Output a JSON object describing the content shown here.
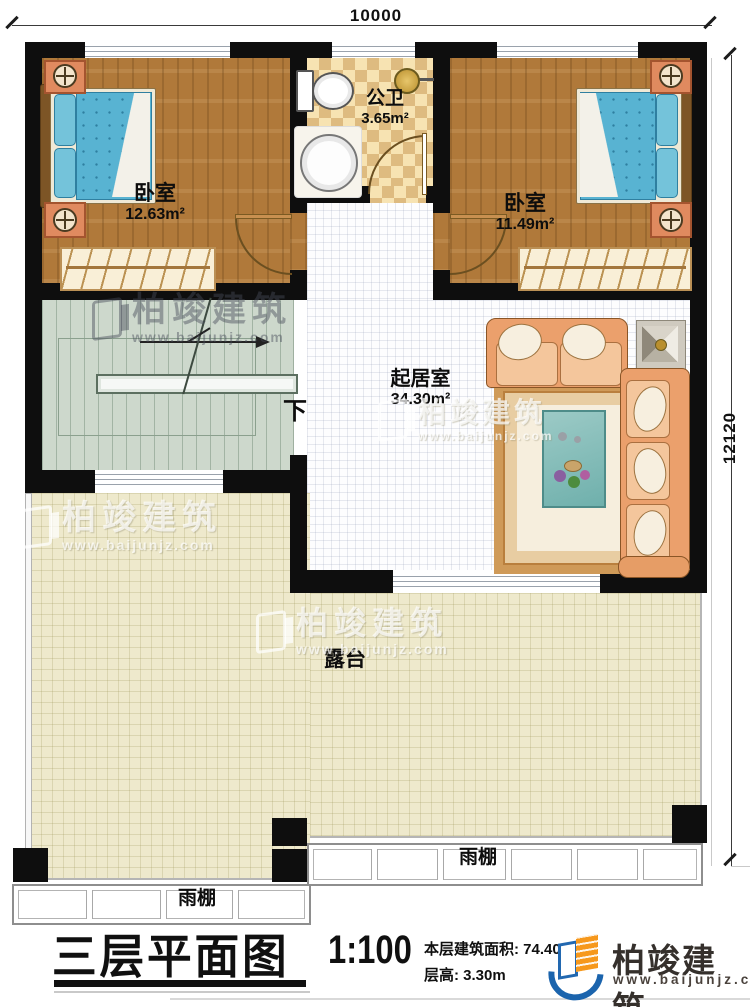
{
  "dimensions": {
    "width": "10000",
    "height": "12120"
  },
  "rooms": {
    "bedroom_left": {
      "name": "卧室",
      "area": "12.63m²"
    },
    "bathroom": {
      "name": "公卫",
      "area": "3.65m²"
    },
    "bedroom_right": {
      "name": "卧室",
      "area": "11.49m²"
    },
    "living_room": {
      "name": "起居室",
      "area": "34.30m²"
    },
    "terrace": {
      "name": "露台"
    },
    "canopy_left": {
      "name": "雨棚"
    },
    "canopy_right": {
      "name": "雨棚"
    },
    "stairs": {
      "down_label": "下"
    }
  },
  "watermark": {
    "brand": "柏竣建筑",
    "website": "www.baijunjz.com"
  },
  "title_block": {
    "title": "三层平面图",
    "scale": "1:100",
    "floor_area": "本层建筑面积: 74.40m²",
    "floor_height": "层高: 3.30m",
    "brand": "柏竣建筑",
    "website": "www.baijunjz.com"
  },
  "colors": {
    "wall": "#0e0e0e",
    "wood_floor": "#b0793a",
    "bed": "#58b3d2",
    "sofa": "#eba06c",
    "terrace": "#eee9cc",
    "stairs": "#cdd8cc",
    "brand_blue": "#1b64ad",
    "brand_orange": "#f6981c"
  }
}
